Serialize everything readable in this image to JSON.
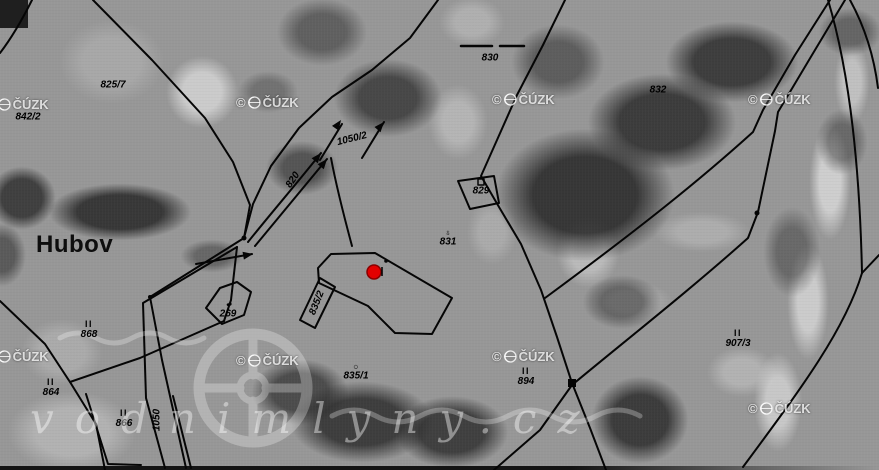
{
  "map": {
    "place_label": "Hubov",
    "cuzk": {
      "copyright": "©",
      "brand": "ČÚZK"
    },
    "watermark_large": "vodnimlyny.cz",
    "colors": {
      "boundary": "#000000",
      "highlight_point": "#e30000",
      "watermark": "#ffffff"
    },
    "parcel_labels": [
      {
        "text": "825/7",
        "x": 113,
        "y": 85
      },
      {
        "text": "842/2",
        "x": 28,
        "y": 117
      },
      {
        "text": "830",
        "x": 490,
        "y": 58
      },
      {
        "text": "832",
        "x": 658,
        "y": 90
      },
      {
        "text": "1050/2",
        "x": 352,
        "y": 139,
        "rot": -14
      },
      {
        "text": "820",
        "x": 293,
        "y": 180,
        "rot": -56
      },
      {
        "text": "829",
        "x": 481,
        "y": 191
      },
      {
        "text": "831",
        "x": 448,
        "y": 238,
        "sym": "cross"
      },
      {
        "text": "269",
        "x": 228,
        "y": 310,
        "sym": "dot"
      },
      {
        "text": "835/2",
        "x": 317,
        "y": 303,
        "rot": -68
      },
      {
        "text": "835/1",
        "x": 356,
        "y": 372,
        "sym": "ring"
      },
      {
        "text": "868",
        "x": 89,
        "y": 330,
        "mark": "II"
      },
      {
        "text": "864",
        "x": 51,
        "y": 388,
        "mark": "II"
      },
      {
        "text": "866",
        "x": 124,
        "y": 419,
        "mark": "II"
      },
      {
        "text": "894",
        "x": 526,
        "y": 377,
        "mark": "II"
      },
      {
        "text": "907/3",
        "x": 738,
        "y": 339,
        "mark": "II"
      },
      {
        "text": "1050",
        "x": 157,
        "y": 420,
        "rot": -90
      }
    ]
  }
}
